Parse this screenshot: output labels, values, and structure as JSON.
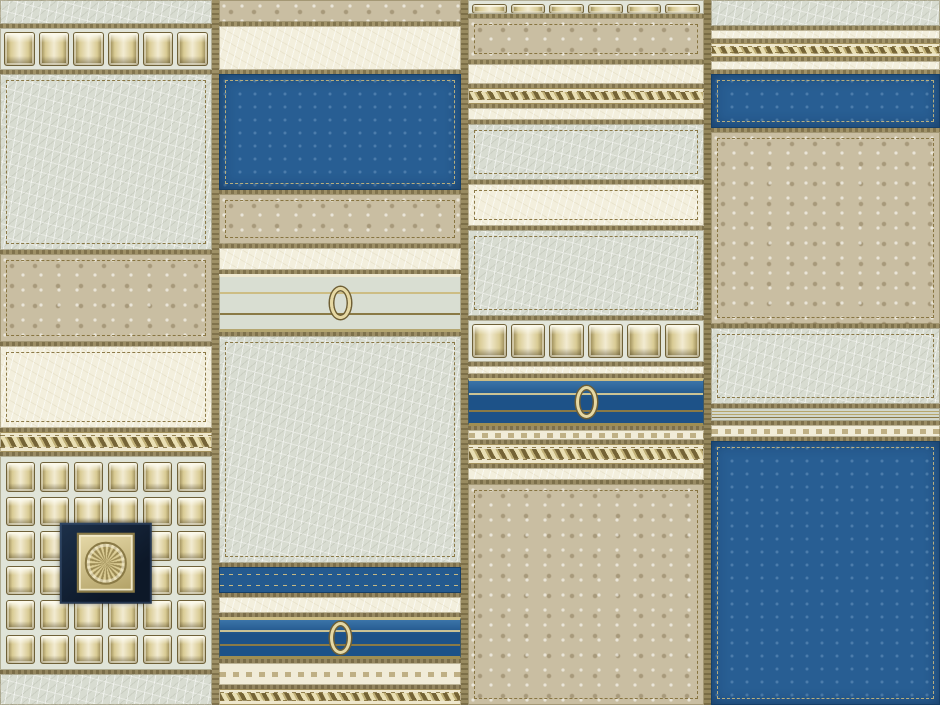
{
  "meta": {
    "description": "Patchwork faux-leather wallpaper pattern: four vertical strips of stitched leather panels (crackled ivory, sage-gray crackle, metallic pebbled taupe, deep blue) joined by gold stitched seams, with rows of gold pyramid studs, braided gold rope bands, blue bands with gold rails and a gold ring ornament, and a dark navy medallion with a gold rosette set in a studded grid.",
    "width_px": 940,
    "height_px": 705
  },
  "palette": {
    "seam_gold": "#9a8c60",
    "crackle_sage": "#d8dcd1",
    "cream_ivory": "#f3efdd",
    "pebble_taupe": "#c9bea2",
    "leather_blue": "#285e93",
    "blue_dark_edge": "#163f68",
    "stud_gold_light": "#f2ebd1",
    "stud_gold_mid": "#d9cb94",
    "stud_gold_dark": "#8c7c49",
    "stitch_gold": "#826e37",
    "medallion_navy": "#12233a",
    "rosette_gold": "#dccd95"
  },
  "ornaments": {
    "ring_icon": "gold marquise ring",
    "rosette_icon": "gold circular rosette in square gold frame on navy ground",
    "stud_icon": "gold beveled square stud",
    "rope_icon": "braided gold rope band"
  },
  "columns": [
    {
      "name": "patch-column-1",
      "width": 212,
      "segments": [
        {
          "type": "crackle",
          "h": 24
        },
        {
          "type": "studs-row",
          "h": 42,
          "studs": 6
        },
        {
          "type": "crackle",
          "h": 176,
          "stitched": true
        },
        {
          "type": "pebble",
          "h": 88,
          "stitched": true
        },
        {
          "type": "cream",
          "h": 82,
          "stitched": true
        },
        {
          "type": "rope",
          "h": 20
        },
        {
          "type": "studs-grid",
          "h": 214,
          "cols": 6,
          "rows": 6,
          "medallion": true
        },
        {
          "type": "crackle",
          "fill": true
        }
      ]
    },
    {
      "name": "patch-column-2",
      "width": 242,
      "segments": [
        {
          "type": "pebble",
          "h": 22
        },
        {
          "type": "cream",
          "h": 44
        },
        {
          "type": "blue",
          "h": 116,
          "stitched": true
        },
        {
          "type": "pebble",
          "h": 50,
          "stitched": true
        },
        {
          "type": "cream",
          "h": 22
        },
        {
          "type": "gray-ornament",
          "h": 58
        },
        {
          "type": "crackle",
          "fill": true,
          "stitched": true
        },
        {
          "type": "blue-plain",
          "h": 26
        },
        {
          "type": "cream",
          "h": 16
        },
        {
          "type": "blue-ornament",
          "h": 42
        },
        {
          "type": "cream-deco",
          "h": 22
        },
        {
          "type": "rope",
          "h": 16
        }
      ]
    },
    {
      "name": "patch-column-3",
      "width": 236,
      "segments": [
        {
          "type": "studs-row",
          "h": 14,
          "studs": 6
        },
        {
          "type": "pebble",
          "h": 42,
          "stitched": true
        },
        {
          "type": "cream",
          "h": 20
        },
        {
          "type": "rope",
          "h": 16
        },
        {
          "type": "cream",
          "h": 12
        },
        {
          "type": "crackle",
          "h": 56,
          "stitched": true
        },
        {
          "type": "cream",
          "h": 42,
          "stitched": true
        },
        {
          "type": "crackle",
          "h": 86,
          "stitched": true
        },
        {
          "type": "studs-row",
          "h": 42,
          "studs": 6
        },
        {
          "type": "cream",
          "h": 8
        },
        {
          "type": "blue-ornament",
          "h": 48
        },
        {
          "type": "cream-deco",
          "h": 10
        },
        {
          "type": "rope",
          "h": 20
        },
        {
          "type": "cream",
          "h": 12
        },
        {
          "type": "pebble",
          "fill": true,
          "stitched": true
        }
      ]
    },
    {
      "name": "patch-column-4",
      "width": 226,
      "fill": true,
      "segments": [
        {
          "type": "crackle",
          "h": 26
        },
        {
          "type": "cream",
          "h": 9
        },
        {
          "type": "rope",
          "h": 14
        },
        {
          "type": "cream",
          "h": 9
        },
        {
          "type": "blue",
          "h": 54,
          "stitched": true
        },
        {
          "type": "pebble",
          "h": 192,
          "stitched": true
        },
        {
          "type": "crackle",
          "h": 76,
          "stitched": true
        },
        {
          "type": "trim-gray",
          "h": 13
        },
        {
          "type": "cream-deco",
          "h": 12
        },
        {
          "type": "blue",
          "fill": true,
          "stitched": true
        }
      ]
    }
  ]
}
